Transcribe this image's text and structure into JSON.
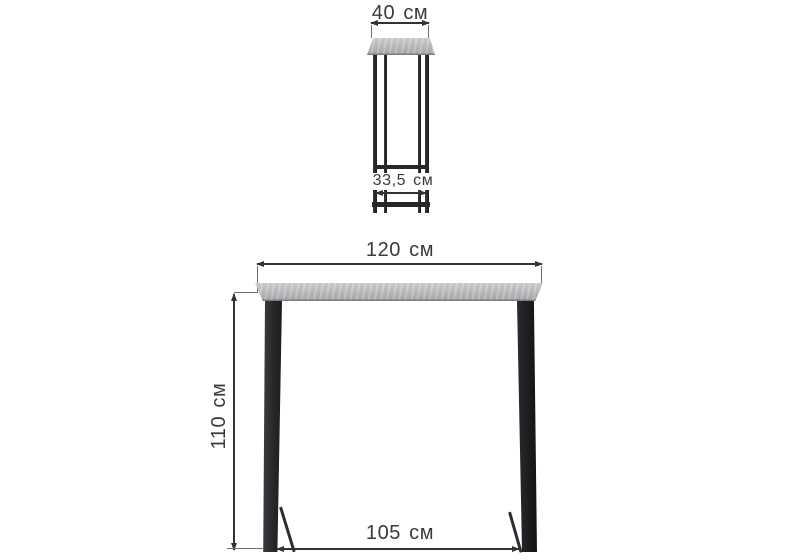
{
  "diagram": {
    "side_view": {
      "top_width_label": "40 см",
      "leg_span_label": "33,5 см"
    },
    "front_view": {
      "width_label": "120 см",
      "height_label": "110 см",
      "leg_span_label": "105 см"
    },
    "colors": {
      "background": "#ffffff",
      "dimension_line": "#333333",
      "extension_line": "#6e6e6e",
      "label_text": "#3a3a3a",
      "metal_frame": "#26272a",
      "tabletop_light": "#d0d1d3",
      "tabletop_dark": "#a6a8aa"
    }
  }
}
